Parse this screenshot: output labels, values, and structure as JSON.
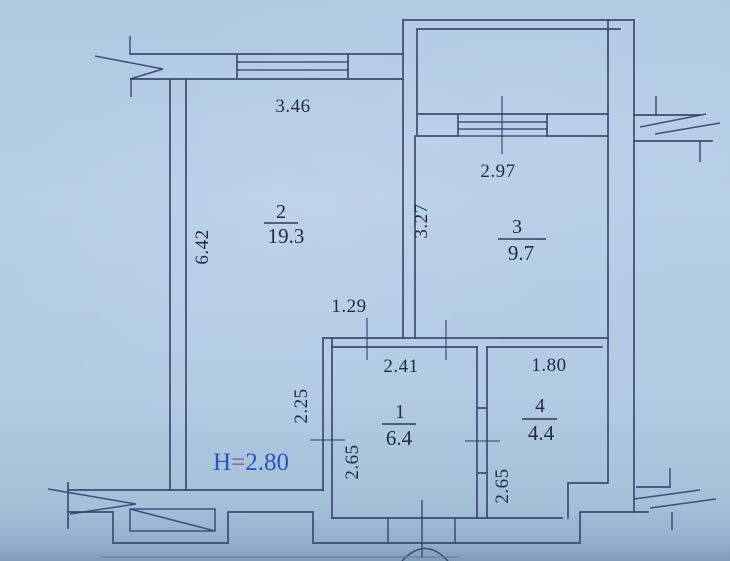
{
  "plan": {
    "height_note": {
      "symbol": "H",
      "equals": "=",
      "value": "2.80"
    },
    "rooms": [
      {
        "number": "1",
        "area": "6.4"
      },
      {
        "number": "2",
        "area": "19.3"
      },
      {
        "number": "3",
        "area": "9.7"
      },
      {
        "number": "4",
        "area": "4.4"
      }
    ],
    "dimensions": {
      "room2_width": "3.46",
      "room2_side": "6.42",
      "room3_width": "2.97",
      "room3_side": "3.27",
      "hall_top_offset": "1.29",
      "room1_width": "2.41",
      "room2_lower_side": "2.25",
      "room1_side": "2.65",
      "room4_width": "1.80",
      "room4_side": "2.65"
    },
    "colors": {
      "paper": "#b2cae4",
      "ink": "#32426a",
      "text": "#1e2a4c",
      "height_blue": "#2a54c6",
      "equals_tint": "#8d4b92"
    }
  }
}
